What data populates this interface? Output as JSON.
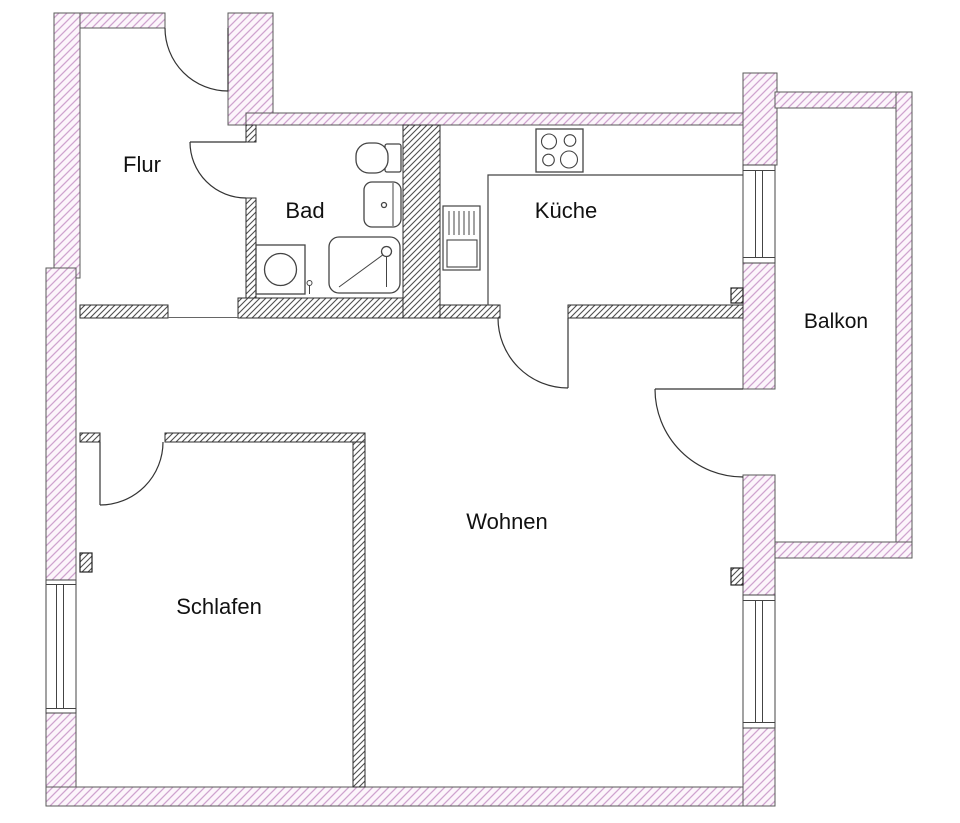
{
  "title": "Wohnungsgrundriss",
  "rooms": {
    "flur": {
      "label": "Flur"
    },
    "bad": {
      "label": "Bad"
    },
    "kueche": {
      "label": "Küche"
    },
    "balkon": {
      "label": "Balkon"
    },
    "wohnen": {
      "label": "Wohnen"
    },
    "schlafen": {
      "label": "Schlafen"
    }
  },
  "colors": {
    "background": "#ffffff",
    "exterior_wall_hatch": "#cfa3cf",
    "exterior_wall_fill": "#fcf5fb",
    "exterior_wall_outline": "#5a5a5a",
    "interior_wall_hatch": "#4f4f4f",
    "interior_wall_fill": "#ffffff",
    "line": "#333333",
    "label_text": "#111111"
  }
}
